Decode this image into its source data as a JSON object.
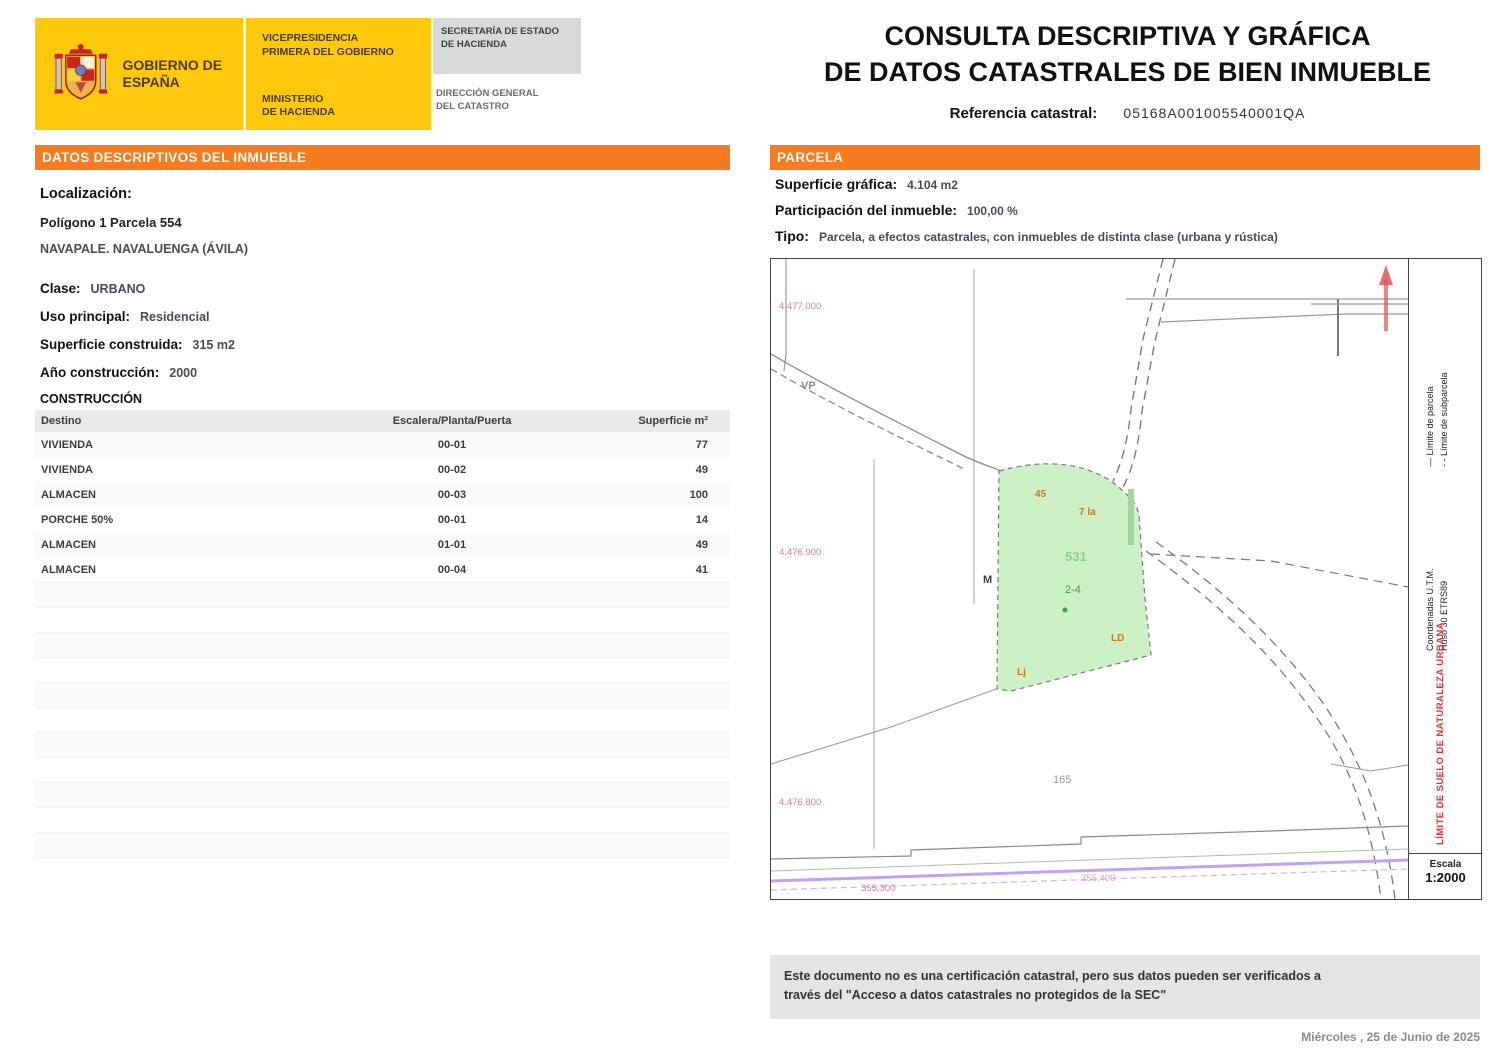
{
  "header": {
    "government": "GOBIERNO\nDE ESPAÑA",
    "ministry_top": "VICEPRESIDENCIA\nPRIMERA DEL GOBIERNO",
    "ministry_bottom": "MINISTERIO\nDE HACIENDA",
    "secretary": "SECRETARÍA DE ESTADO\nDE HACIENDA",
    "direction": "DIRECCIÓN GENERAL\nDEL CATASTRO",
    "title_line1": "CONSULTA DESCRIPTIVA Y GRÁFICA",
    "title_line2": "DE DATOS CATASTRALES DE BIEN INMUEBLE",
    "ref_label": "Referencia catastral:",
    "ref_value": "05168A001005540001QA"
  },
  "left_panel": {
    "banner": "DATOS DESCRIPTIVOS DEL INMUEBLE",
    "localizacion_label": "Localización:",
    "localizacion_line1": "Polígono 1 Parcela 554",
    "localizacion_line2": "NAVAPALE. NAVALUENGA (ÁVILA)",
    "clase_label": "Clase:",
    "clase_value": "URBANO",
    "uso_label": "Uso principal:",
    "uso_value": "Residencial",
    "superficie_label": "Superficie construida:",
    "superficie_value": "315 m2",
    "anio_label": "Año construcción:",
    "anio_value": "2000",
    "construccion_title": "CONSTRUCCIÓN",
    "table": {
      "headers": [
        "Destino",
        "Escalera/Planta/Puerta",
        "Superficie m²"
      ],
      "rows": [
        [
          "VIVIENDA",
          "00-01",
          "77"
        ],
        [
          "VIVIENDA",
          "00-02",
          "49"
        ],
        [
          "ALMACEN",
          "00-03",
          "100"
        ],
        [
          "PORCHE 50%",
          "00-01",
          "14"
        ],
        [
          "ALMACEN",
          "01-01",
          "49"
        ],
        [
          "ALMACEN",
          "00-04",
          "41"
        ]
      ]
    }
  },
  "right_panel": {
    "banner": "PARCELA",
    "superficie_grafica_label": "Superficie gráfica:",
    "superficie_grafica_value": "4.104 m2",
    "participacion_label": "Participación del inmueble:",
    "participacion_value": "100,00 %",
    "tipo_label": "Tipo:",
    "tipo_value": "Parcela, a efectos catastrales, con inmuebles de distinta clase (urbana y rústica)",
    "map": {
      "coord_y_top": "4.477.000",
      "coord_y_mid": "4.476.900",
      "coord_y_bot": "4.476.800",
      "coord_x_left": "355.300",
      "coord_x_right": "355.400",
      "road_label": "VP",
      "parcel_number": "531",
      "parcel_sub": "2-4",
      "neighbor_label": "165",
      "edge_label": "M",
      "constr_label_1": "45",
      "constr_label_2": "7 la",
      "constr_label_3": "LD",
      "constr_label_4": "Lj",
      "legend1_line1": "— Límite de parcela",
      "legend1_line2": "- - Límite de subparcela",
      "legend2_line1": "Coordenadas U.T.M.",
      "legend2_line2": "Huso 30 ETRS89",
      "legend_red": "LÍMITE DE SUELO DE NATURALEZA URBANA",
      "scale_label": "Escala",
      "scale_value": "1:2000"
    }
  },
  "footer": {
    "disclaimer_line1": "Este documento no es una certificación catastral, pero sus datos pueden ser verificados a",
    "disclaimer_line2": "través del \"Acceso a datos catastrales no protegidos de la SEC\"",
    "date": "Miércoles , 25 de Junio de 2025"
  },
  "colors": {
    "accent_orange": "#f47b20",
    "brand_yellow": "#ffc90b",
    "parcel_green": "#cbf1c4",
    "via_purple": "#bfa3ee",
    "coord_red": "#d9837f"
  }
}
